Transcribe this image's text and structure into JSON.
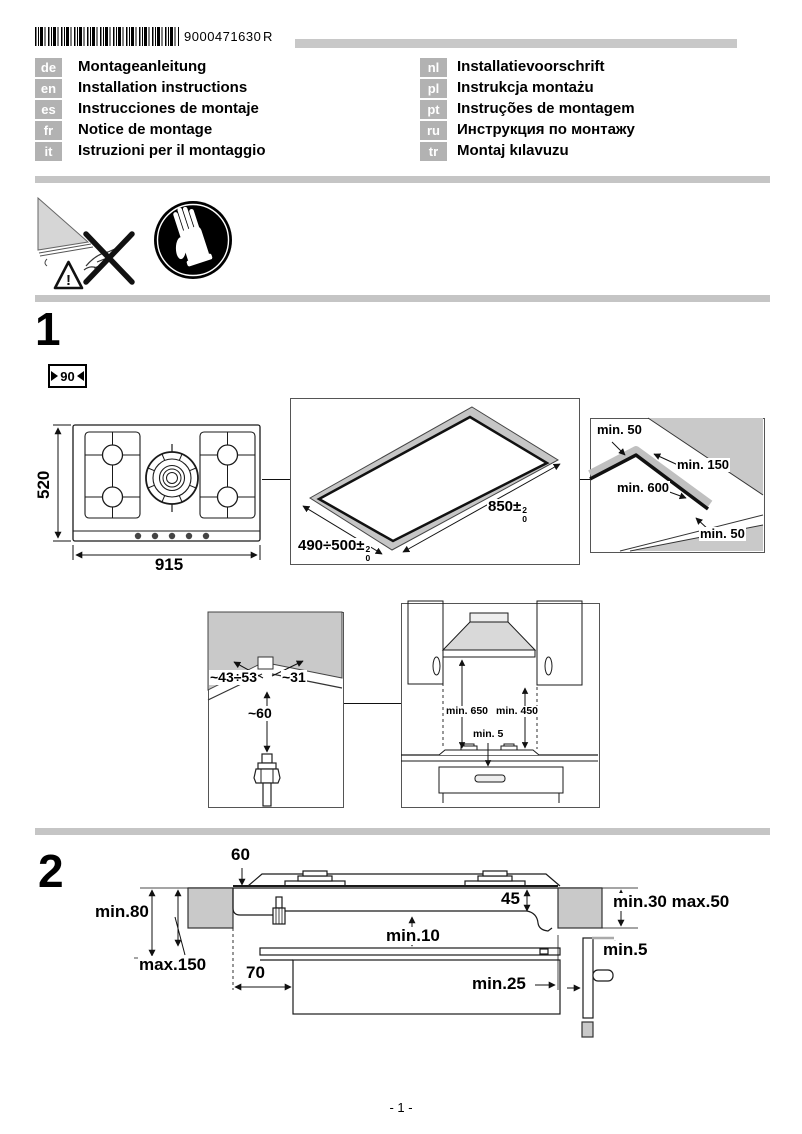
{
  "header": {
    "barcode_number": "9000471630",
    "revision": "R"
  },
  "languages": {
    "left": [
      {
        "code": "de",
        "label": "Montageanleitung"
      },
      {
        "code": "en",
        "label": "Installation instructions"
      },
      {
        "code": "es",
        "label": "Instrucciones de montaje"
      },
      {
        "code": "fr",
        "label": "Notice de montage"
      },
      {
        "code": "it",
        "label": "Istruzioni per il montaggio"
      }
    ],
    "right": [
      {
        "code": "nl",
        "label": "Installatievoorschrift"
      },
      {
        "code": "pl",
        "label": "Instrukcja montażu"
      },
      {
        "code": "pt",
        "label": "Instruções de montagem"
      },
      {
        "code": "ru",
        "label": "Инструкция по монтажу"
      },
      {
        "code": "tr",
        "label": "Montaj kılavuzu"
      }
    ]
  },
  "safety_icons": [
    "sharp-edge-warning-icon",
    "wear-gloves-icon"
  ],
  "section1": {
    "number": "1",
    "hob_width_badge": "90",
    "hob_top_view": {
      "depth": "520",
      "width": "915"
    },
    "cutout": {
      "width": "490÷500±",
      "width_tol_plus": "2",
      "width_tol_minus": "0",
      "length": "850±",
      "length_tol_plus": "2",
      "length_tol_minus": "0"
    },
    "clearances": {
      "rear": "min. 50",
      "side_right": "min. 150",
      "front": "min. 600",
      "side_front": "min. 50"
    },
    "gas_connection": {
      "left": "~43÷53",
      "right": "~31",
      "below": "~60"
    },
    "hood_clearance": {
      "hood": "min. 650",
      "cabinet": "min. 450",
      "gap": "min. 5"
    }
  },
  "section2": {
    "number": "2",
    "dims": {
      "worktop_thickness": "60",
      "min_height_left": "min.80",
      "max_height_left": "max.150",
      "front_distance": "70",
      "bottom_clearance": "min.10",
      "recess_depth": "45",
      "right_range": "min.30 max.50",
      "panel_gap": "min.5",
      "rear_clearance": "min.25"
    }
  },
  "footer": {
    "page_number": "- 1 -"
  },
  "colors": {
    "worktop_gray": "#c9c9c9",
    "separator_gray": "#c5c5c5",
    "badge_gray": "#b2b2b2"
  }
}
